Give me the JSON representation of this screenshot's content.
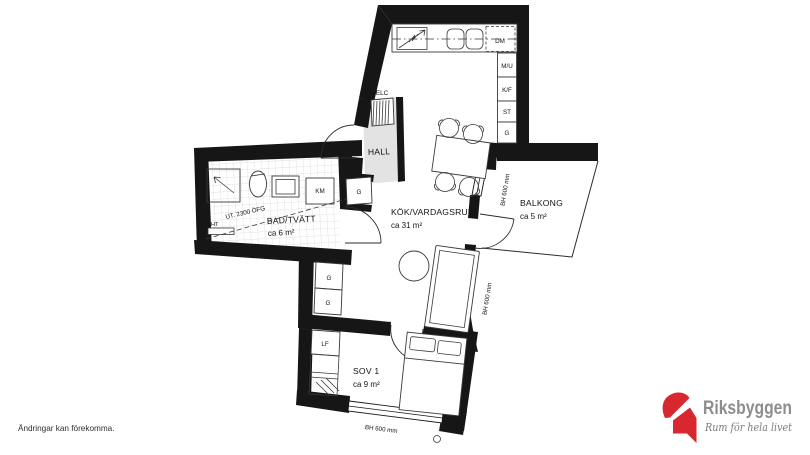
{
  "plan": {
    "rooms": {
      "hall": {
        "label": "HALL"
      },
      "kitchen_living": {
        "label": "KÖK/VARDAGSRUM",
        "area": "ca 31 m²"
      },
      "bathroom": {
        "label": "BAD/TVÄTT",
        "area": "ca 6 m²"
      },
      "balcony": {
        "label": "BALKONG",
        "area": "ca 5 m²"
      },
      "bedroom": {
        "label": "SOV 1",
        "area": "ca 9 m²"
      }
    },
    "labels": {
      "elc": "ELC",
      "dm": "DM",
      "mu": "M/U",
      "kf": "K/F",
      "st": "ST",
      "g": "G",
      "km": "KM",
      "ht": "HT",
      "lf": "LF"
    },
    "annotations": {
      "ceiling_height": "UT. 2300 ÖFG",
      "window_height": "BH 600 mm"
    }
  },
  "footer": {
    "disclaimer": "Ändringar kan förekomma."
  },
  "logo": {
    "brand": "Riksbyggen",
    "tagline": "Rum för hela livet",
    "brand_color": "#d7282f",
    "text_color": "#8d8d8d",
    "tagline_color": "#7b7b7b"
  }
}
